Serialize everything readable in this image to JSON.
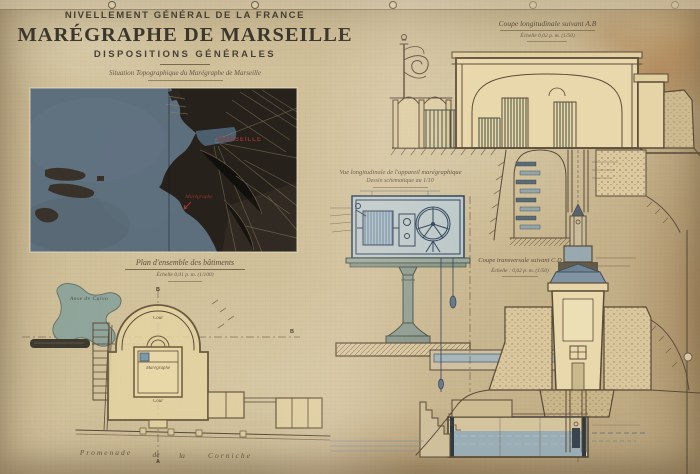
{
  "poster": {
    "header": {
      "org": "NIVELLEMENT GÉNÉRAL DE LA FRANCE",
      "title": "MARÉGRAPHE DE MARSEILLE",
      "subtitle": "DISPOSITIONS GÉNÉRALES"
    },
    "map": {
      "caption": "Situation Topographique du Marégraphe de Marseille",
      "city_label": "MARSEILLE",
      "gauge_label": "Marégraphe"
    },
    "plan": {
      "title": "Plan d'ensemble des bâtiments",
      "scale": "Échelle 0,01 p. m. (1/100)",
      "cove_label": "Anse de Calvo",
      "court_label_top": "Cour",
      "court_label_bottom": "Cour",
      "building_label": "Marégraphe",
      "promenade": [
        "Promenade",
        "de",
        "la",
        "Corniche"
      ],
      "marker_b_top": "B",
      "marker_b_right": "B",
      "marker_a_bottom": "A"
    },
    "coupe_ab": {
      "title": "Coupe longitudinale suivant A.B",
      "scale": "Échelle 0,02 p. m. (1/50)"
    },
    "apparatus": {
      "title": "Vue longitudinale de l'appareil marégraphique",
      "subtitle": "Dessin schématique au 1/10"
    },
    "coupe_cd": {
      "title": "Coupe transversale suivant C.D",
      "scale": "Échelle : 0,02 p. m. (1/50)"
    },
    "colors": {
      "paper": "#cfc09c",
      "ink": "#5a4a38",
      "blueprint_ink": "#31425a",
      "red_label": "#a83430",
      "sea": "#5d6e7c",
      "city": "#26211b",
      "section_water": "#8fa8b5"
    }
  }
}
